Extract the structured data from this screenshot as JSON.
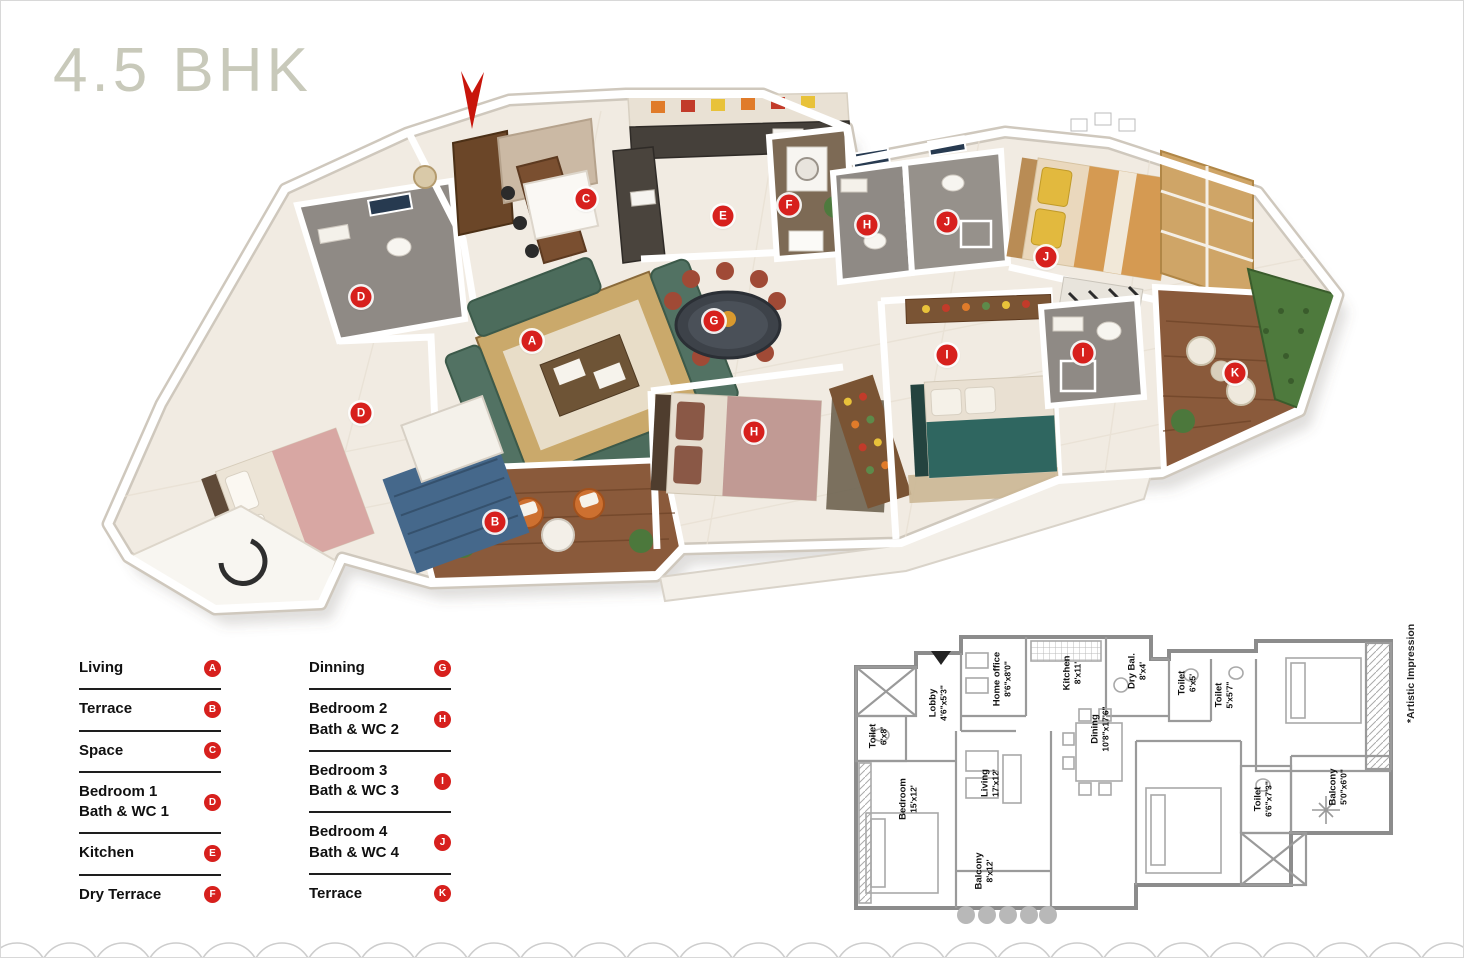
{
  "title": "4.5 BHK",
  "colors": {
    "accent_red": "#d7201d",
    "title_color": "#c8c9ba",
    "wall_gray": "#8c8c8c",
    "floor_cream": "#f1ebe2"
  },
  "legend": {
    "columns": [
      {
        "items": [
          {
            "lines": [
              "Living"
            ],
            "badge": "A"
          },
          {
            "lines": [
              "Terrace"
            ],
            "badge": "B"
          },
          {
            "lines": [
              "Space"
            ],
            "badge": "C"
          },
          {
            "lines": [
              "Bedroom 1",
              "Bath & WC 1"
            ],
            "badge": "D"
          },
          {
            "lines": [
              "Kitchen"
            ],
            "badge": "E"
          },
          {
            "lines": [
              "Dry Terrace"
            ],
            "badge": "F"
          }
        ]
      },
      {
        "items": [
          {
            "lines": [
              "Dinning"
            ],
            "badge": "G"
          },
          {
            "lines": [
              "Bedroom 2",
              "Bath & WC 2"
            ],
            "badge": "H"
          },
          {
            "lines": [
              "Bedroom 3",
              "Bath & WC 3"
            ],
            "badge": "I"
          },
          {
            "lines": [
              "Bedroom 4",
              "Bath & WC 4"
            ],
            "badge": "J"
          },
          {
            "lines": [
              "Terrace"
            ],
            "badge": "K"
          }
        ]
      }
    ]
  },
  "plan3d": {
    "markers": [
      {
        "letter": "A",
        "x": 531,
        "y": 340,
        "area": "living"
      },
      {
        "letter": "B",
        "x": 494,
        "y": 521,
        "area": "terrace"
      },
      {
        "letter": "C",
        "x": 585,
        "y": 198,
        "area": "space"
      },
      {
        "letter": "D",
        "x": 360,
        "y": 296,
        "area": "bath-wc-1"
      },
      {
        "letter": "D",
        "x": 360,
        "y": 412,
        "area": "bedroom-1"
      },
      {
        "letter": "E",
        "x": 722,
        "y": 215,
        "area": "kitchen"
      },
      {
        "letter": "F",
        "x": 788,
        "y": 204,
        "area": "dry-terrace"
      },
      {
        "letter": "G",
        "x": 713,
        "y": 320,
        "area": "dinning"
      },
      {
        "letter": "H",
        "x": 866,
        "y": 224,
        "area": "bath-wc-2"
      },
      {
        "letter": "H",
        "x": 753,
        "y": 431,
        "area": "bedroom-2"
      },
      {
        "letter": "J",
        "x": 946,
        "y": 221,
        "area": "bath-wc-4"
      },
      {
        "letter": "J",
        "x": 1045,
        "y": 256,
        "area": "bedroom-4"
      },
      {
        "letter": "I",
        "x": 946,
        "y": 354,
        "area": "bedroom-3"
      },
      {
        "letter": "I",
        "x": 1082,
        "y": 352,
        "area": "bath-wc-3"
      },
      {
        "letter": "K",
        "x": 1234,
        "y": 372,
        "area": "terrace-2"
      }
    ]
  },
  "plan2d": {
    "note": "*Artistic Impression",
    "labels": [
      {
        "name": "Toilet",
        "dims": "6'x8'",
        "x": 28,
        "y": 113
      },
      {
        "name": "Lobby",
        "dims": "4'6\"x5'3\"",
        "x": 88,
        "y": 80
      },
      {
        "name": "Home office",
        "dims": "8'6\"x8'0\"",
        "x": 152,
        "y": 56
      },
      {
        "name": "Kitchen",
        "dims": "8'x11'",
        "x": 222,
        "y": 50
      },
      {
        "name": "Dining",
        "dims": "10'8\"x17'6\"",
        "x": 250,
        "y": 106
      },
      {
        "name": "Dry Bal.",
        "dims": "8'x4'",
        "x": 287,
        "y": 48
      },
      {
        "name": "Toilet",
        "dims": "6'x5'",
        "x": 337,
        "y": 60
      },
      {
        "name": "Toilet",
        "dims": "5'x5'7\"",
        "x": 374,
        "y": 72
      },
      {
        "name": "Bedroom",
        "dims": "15'x12'",
        "x": 58,
        "y": 176
      },
      {
        "name": "Living",
        "dims": "17'x12'",
        "x": 140,
        "y": 160
      },
      {
        "name": "Balcony",
        "dims": "8'x12'",
        "x": 134,
        "y": 248
      },
      {
        "name": "Toilet",
        "dims": "6'6\"x7'3\"",
        "x": 413,
        "y": 176
      },
      {
        "name": "Balcony",
        "dims": "5'0\"x6'0\"",
        "x": 488,
        "y": 164
      }
    ]
  }
}
